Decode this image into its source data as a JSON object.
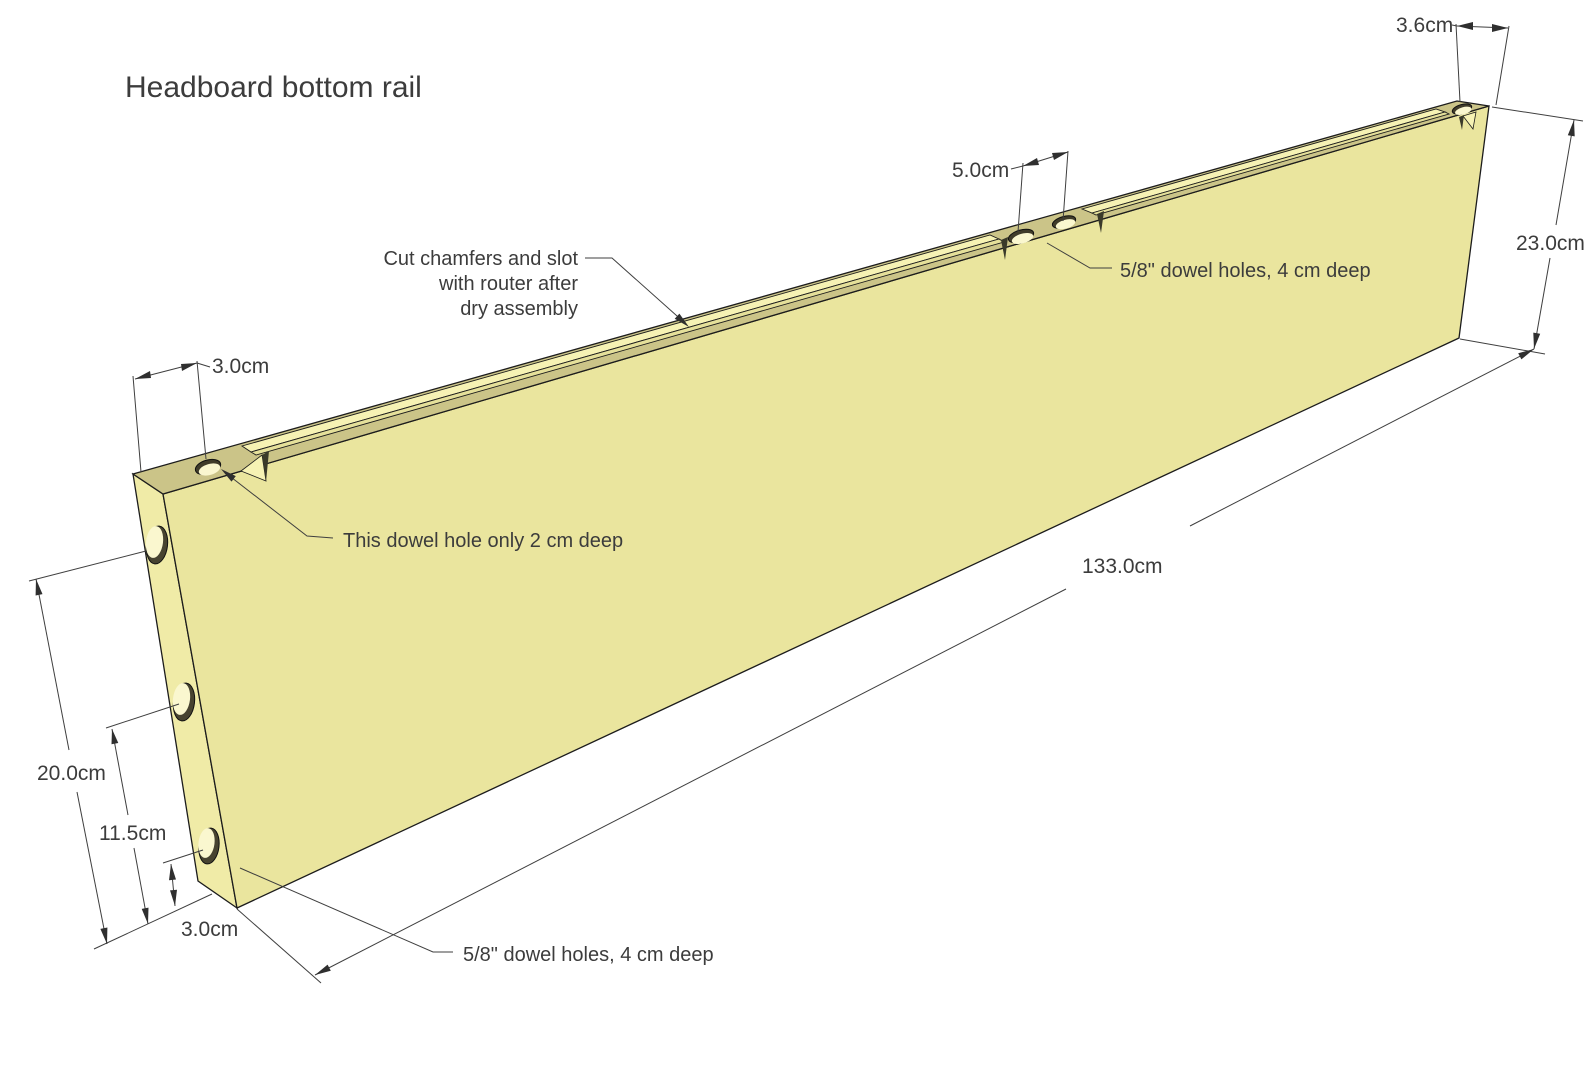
{
  "title": "Headboard bottom rail",
  "annotations": {
    "chamfer_note_line1": "Cut chamfers and slot",
    "chamfer_note_line2": "with router after",
    "chamfer_note_line3": "dry assembly",
    "shallow_hole_note": "This dowel hole only 2 cm deep",
    "dowel_holes_top_note": "5/8\" dowel holes, 4 cm deep",
    "dowel_holes_bottom_note": "5/8\" dowel holes, 4 cm deep"
  },
  "dimensions": {
    "right_tab_width": "3.6cm",
    "mid_hole_spacing": "5.0cm",
    "board_height": "23.0cm",
    "board_length": "133.0cm",
    "left_tab_hole_offset": "3.0cm",
    "end_hole_top_offset": "20.0cm",
    "end_hole_mid_offset": "11.5cm",
    "end_hole_bottom_offset": "3.0cm"
  },
  "colors": {
    "background": "#FFFFFF",
    "face": "#EAE59E",
    "end_face": "#F0EBA7",
    "top_face": "#CBC488",
    "chamfer_highlight": "#F6F2B4",
    "slot": "#E5E09A",
    "hole_light": "#FAF7CF",
    "hole_shadow": "#474330",
    "outline": "#1C1C1C",
    "dimension_lines": "#3F3F3F",
    "text": "#3C3C3C"
  }
}
